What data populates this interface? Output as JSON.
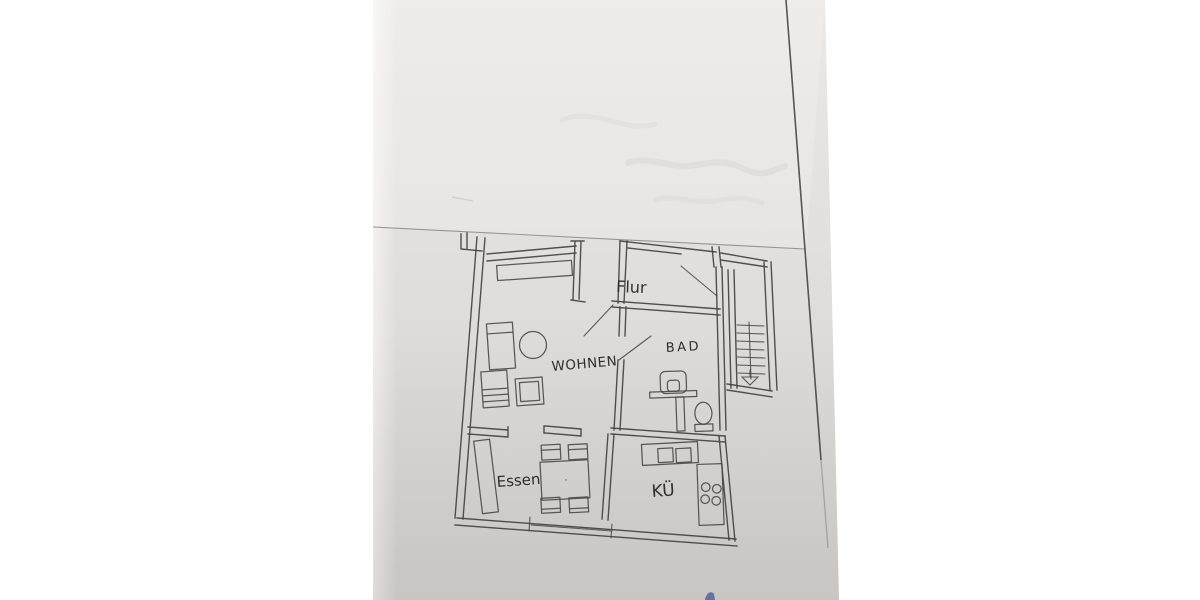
{
  "floor_plan": {
    "rooms": [
      {
        "key": "flur",
        "label": "Flur"
      },
      {
        "key": "wohnen",
        "label": "WOHNEN"
      },
      {
        "key": "bad",
        "label": "BAD"
      },
      {
        "key": "essen",
        "label": "Essen"
      },
      {
        "key": "kueche",
        "label": "KÜ"
      }
    ]
  },
  "colors": {
    "background": "#ffffff",
    "paper_top": "#ebe9e6",
    "paper_mid": "#e2e0dd",
    "paper_bottom": "#d3d1ce",
    "ink": "#44423f",
    "label_ink": "#2f2e2b",
    "blue_ink": "#56619e"
  }
}
